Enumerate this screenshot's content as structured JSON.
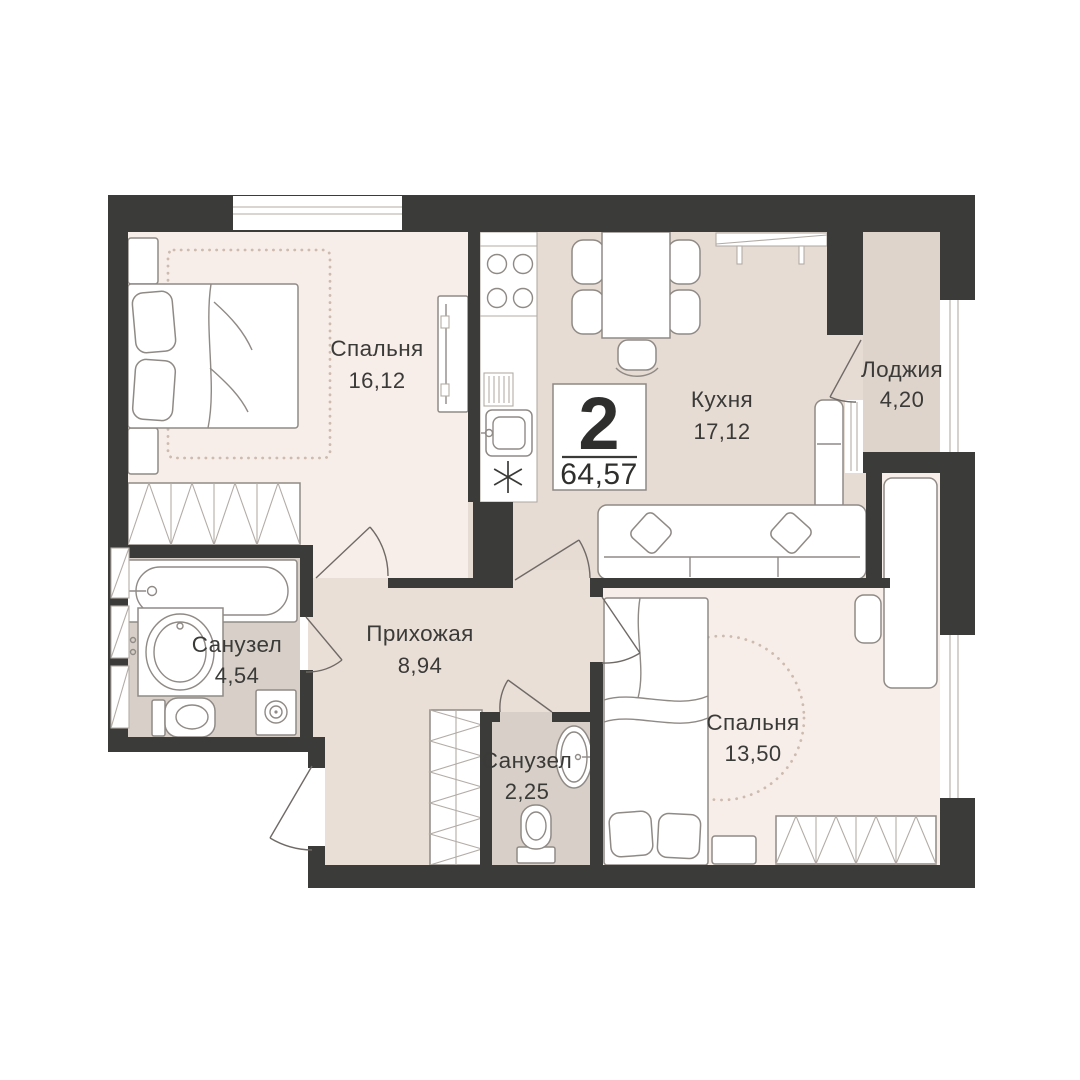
{
  "badge": {
    "rooms_count": "2",
    "total_area": "64,57"
  },
  "rooms": [
    {
      "id": "bedroom-1",
      "name": "Спальня",
      "area": "16,12"
    },
    {
      "id": "kitchen",
      "name": "Кухня",
      "area": "17,12"
    },
    {
      "id": "loggia",
      "name": "Лоджия",
      "area": "4,20"
    },
    {
      "id": "bathroom-1",
      "name": "Санузел",
      "area": "4,54"
    },
    {
      "id": "hallway",
      "name": "Прихожая",
      "area": "8,94"
    },
    {
      "id": "bathroom-2",
      "name": "Санузел",
      "area": "2,25"
    },
    {
      "id": "bedroom-2",
      "name": "Спальня",
      "area": "13,50"
    }
  ],
  "colors": {
    "wall": "#3b3b39",
    "floor_bedroom": "#f8eee9",
    "floor_kitchen": "#e7dcd4",
    "floor_hallway": "#eadfd7",
    "floor_bath": "#d8d0c8",
    "floor_loggia": "#ded4cb",
    "furniture_line": "#8f8a85",
    "furniture_line_soft": "#b3aca6",
    "rug_dots": "#cdbbb0",
    "door_line": "#6f6a66",
    "text": "#3a3a38",
    "badge_border": "#8d8883",
    "background": "#ffffff"
  }
}
